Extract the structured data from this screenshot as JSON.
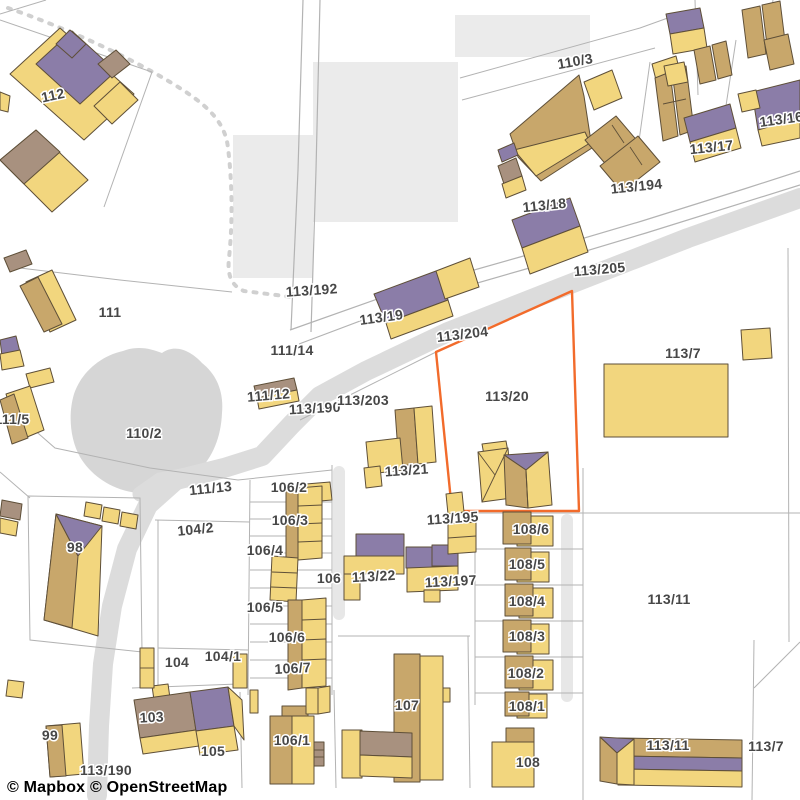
{
  "map": {
    "type": "cadastral-parcel-map",
    "provider_attribution": {
      "mapbox": "© Mapbox",
      "osm": "© OpenStreetMap"
    },
    "highlighted_parcel": "113/20",
    "colors": {
      "building-yellow": "#F2D67E",
      "building-tan": "#C8A76B",
      "roof-purple": "#8B7DA8",
      "roof-mauve": "#A8917F",
      "building-outline": "#5E4F38",
      "road-gray": "#DCDCDC",
      "drive-gray": "#E7E7E7",
      "area-gray": "#EBEBEB",
      "pond-gray": "#D6D6D6",
      "line-gray": "#B3B3B3",
      "dash-gray": "#D0D0D0",
      "highlight-orange": "#F26B2B",
      "label-gray": "#474747"
    },
    "labels": [
      {
        "text": "112",
        "x": 54,
        "y": 100,
        "rot": -12
      },
      {
        "text": "110/3",
        "x": 576,
        "y": 66,
        "rot": -10
      },
      {
        "text": "113/16",
        "x": 782,
        "y": 124,
        "rot": -8
      },
      {
        "text": "113/17",
        "x": 712,
        "y": 152,
        "rot": -6
      },
      {
        "text": "113/194",
        "x": 637,
        "y": 191,
        "rot": -6
      },
      {
        "text": "113/18",
        "x": 545,
        "y": 210,
        "rot": -6
      },
      {
        "text": "113/205",
        "x": 600,
        "y": 274,
        "rot": -5
      },
      {
        "text": "113/192",
        "x": 312,
        "y": 295,
        "rot": -4
      },
      {
        "text": "113/19",
        "x": 382,
        "y": 322,
        "rot": -8
      },
      {
        "text": "111",
        "x": 110,
        "y": 317
      },
      {
        "text": "111/14",
        "x": 292,
        "y": 355
      },
      {
        "text": "113/204",
        "x": 463,
        "y": 339,
        "rot": -7
      },
      {
        "text": "113/7",
        "x": 683,
        "y": 358
      },
      {
        "text": "111/12",
        "x": 269,
        "y": 400,
        "rot": -5
      },
      {
        "text": "113/190",
        "x": 315,
        "y": 413,
        "rot": -3
      },
      {
        "text": "113/203",
        "x": 363,
        "y": 405
      },
      {
        "text": "113/20",
        "x": 507,
        "y": 401
      },
      {
        "text": "111/5",
        "x": 12,
        "y": 424
      },
      {
        "text": "110/2",
        "x": 144,
        "y": 438
      },
      {
        "text": "113/21",
        "x": 407,
        "y": 475,
        "rot": -4
      },
      {
        "text": "111/13",
        "x": 211,
        "y": 493,
        "rot": -6
      },
      {
        "text": "106/2",
        "x": 289,
        "y": 492
      },
      {
        "text": "104/2",
        "x": 196,
        "y": 534,
        "rot": -6
      },
      {
        "text": "106/3",
        "x": 290,
        "y": 525
      },
      {
        "text": "98",
        "x": 75,
        "y": 552
      },
      {
        "text": "106/4",
        "x": 265,
        "y": 555
      },
      {
        "text": "113/195",
        "x": 453,
        "y": 523,
        "rot": -4
      },
      {
        "text": "108/6",
        "x": 531,
        "y": 534
      },
      {
        "text": "106",
        "x": 329,
        "y": 583
      },
      {
        "text": "113/22",
        "x": 374,
        "y": 581,
        "rot": -3
      },
      {
        "text": "113/197",
        "x": 451,
        "y": 586,
        "rot": -3
      },
      {
        "text": "108/5",
        "x": 527,
        "y": 569
      },
      {
        "text": "113/11",
        "x": 669,
        "y": 604
      },
      {
        "text": "106/5",
        "x": 265,
        "y": 612
      },
      {
        "text": "108/4",
        "x": 527,
        "y": 606
      },
      {
        "text": "106/6",
        "x": 287,
        "y": 642
      },
      {
        "text": "108/3",
        "x": 527,
        "y": 641
      },
      {
        "text": "104",
        "x": 177,
        "y": 667
      },
      {
        "text": "104/1",
        "x": 223,
        "y": 661
      },
      {
        "text": "106/7",
        "x": 293,
        "y": 673,
        "rot": -3
      },
      {
        "text": "108/2",
        "x": 526,
        "y": 678
      },
      {
        "text": "103",
        "x": 152,
        "y": 722,
        "rot": -3
      },
      {
        "text": "108/1",
        "x": 527,
        "y": 711
      },
      {
        "text": "99",
        "x": 50,
        "y": 740
      },
      {
        "text": "105",
        "x": 213,
        "y": 756
      },
      {
        "text": "106/1",
        "x": 292,
        "y": 745
      },
      {
        "text": "107",
        "x": 407,
        "y": 710
      },
      {
        "text": "113/11",
        "x": 668,
        "y": 750
      },
      {
        "text": "108",
        "x": 528,
        "y": 767
      },
      {
        "text": "113/7",
        "x": 766,
        "y": 751
      },
      {
        "text": "113/190",
        "x": 106,
        "y": 775
      }
    ]
  }
}
